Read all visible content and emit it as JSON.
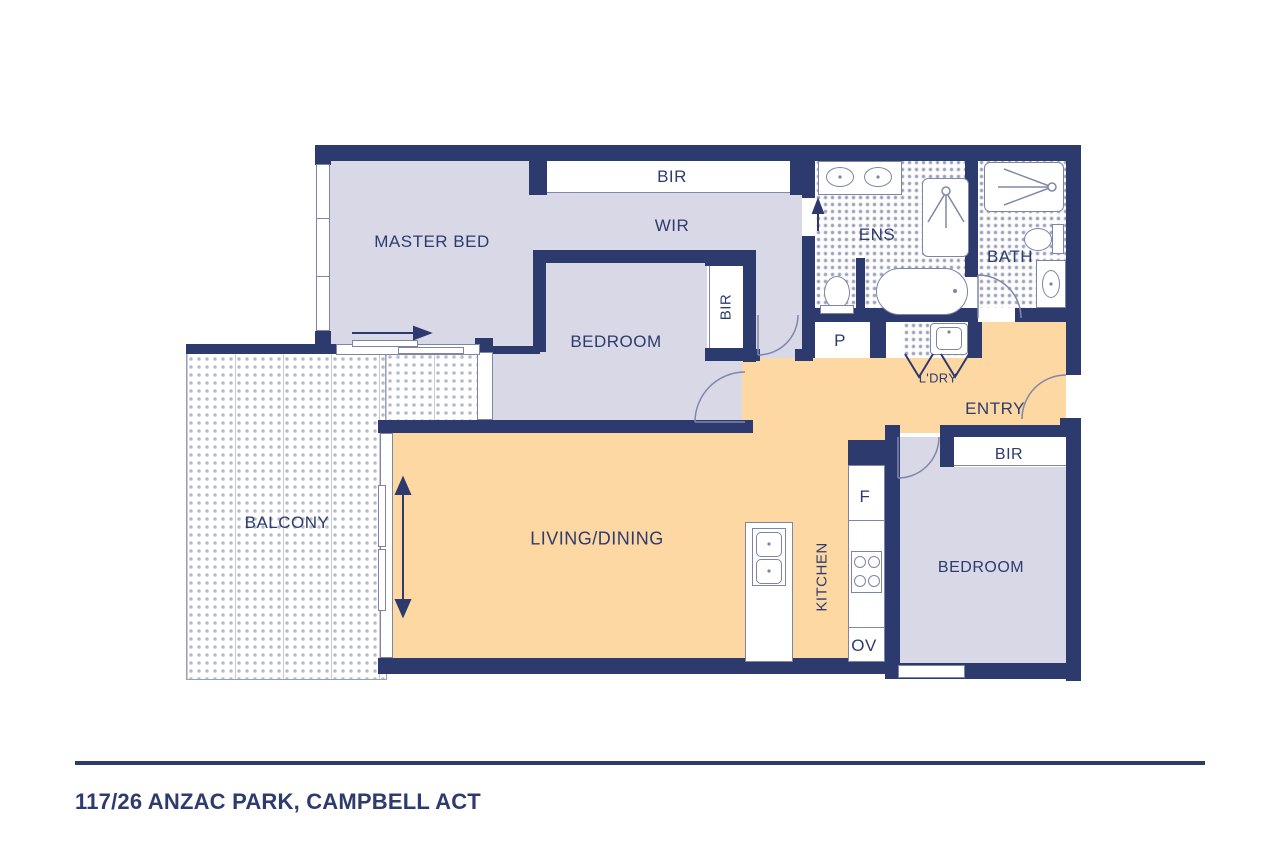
{
  "title": "Floor plan",
  "labels": {
    "master_bed": "MASTER BED",
    "bir_top": "BIR",
    "wir": "WIR",
    "bedroom_center": "BEDROOM",
    "bir_center": "BIR",
    "ens": "ENS",
    "bath": "BATH",
    "pantry": "P",
    "laundry": "L'DRY",
    "entry": "ENTRY",
    "bir_bedroom2": "BIR",
    "bedroom2": "BEDROOM",
    "living_dining": "LIVING/DINING",
    "kitchen": "KITCHEN",
    "fridge": "F",
    "oven": "OV",
    "balcony": "BALCONY"
  },
  "footer": {
    "address": "117/26 ANZAC PARK, CAMPBELL ACT"
  },
  "colors": {
    "wall": "#2d3a6e",
    "ink": "#2e3b6e",
    "purple": "#d8d8e7",
    "orange": "#fdd8a3",
    "fixture_line": "#7d84a6"
  }
}
